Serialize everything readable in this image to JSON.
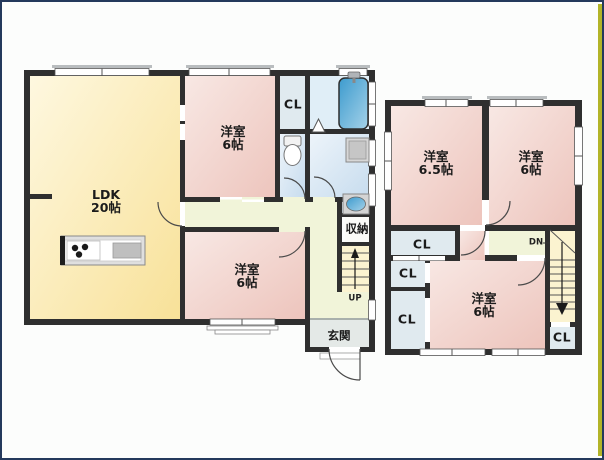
{
  "plan": {
    "type": "floorplan",
    "floors": [
      "1F",
      "2F"
    ]
  },
  "floor1": {
    "ldk": {
      "name": "LDK",
      "size": "20帖"
    },
    "bedroom_top": {
      "name": "洋室",
      "size": "6帖"
    },
    "bedroom_bottom": {
      "name": "洋室",
      "size": "6帖"
    },
    "closet_label": "CL",
    "storage_label": "収納",
    "entrance_label": "玄関",
    "stairs_up_label": "UP"
  },
  "floor2": {
    "bedroom_left": {
      "name": "洋室",
      "size": "6.5帖"
    },
    "bedroom_right": {
      "name": "洋室",
      "size": "6帖"
    },
    "bedroom_bottom": {
      "name": "洋室",
      "size": "6帖"
    },
    "closet1_label": "CL",
    "closet2_label": "CL",
    "closet3_label": "CL",
    "closet4_label": "CL",
    "stairs_down_label": "DN"
  },
  "colors": {
    "wall": "#2f2f2f",
    "room_pink": "#EEC6BF",
    "ldk_yellow": "#F9E49C",
    "wet_blue": "#CBDEEF",
    "closet_blue": "#E0EAEF",
    "hall_green": "#F1F4D9",
    "stair_yellow": "#FBF3D0",
    "entrance_gray": "#E4E9E7",
    "bathtub_blue": "#3D9BCE",
    "border_navy": "#24395c",
    "edge_strip": "#b3b428"
  }
}
